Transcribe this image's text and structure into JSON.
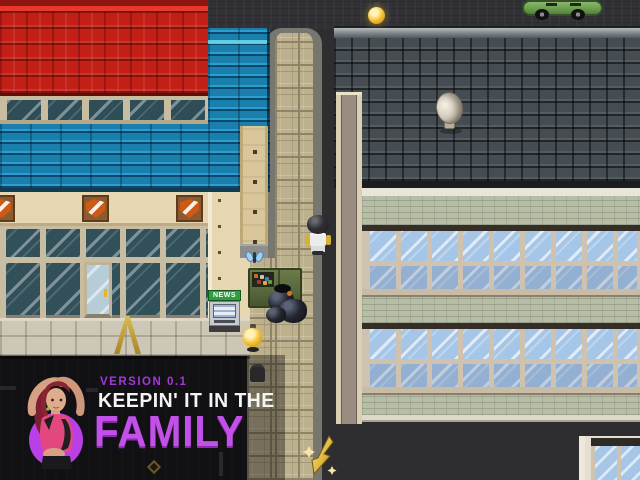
{
  "overlay": {
    "version_label": "VERSION 0.1",
    "title_line1": "KEEPIN' IT IN THE",
    "title_line2": "FAMILY",
    "colors": {
      "version_purple": "#a238da",
      "title_white": "#f4f4f4",
      "family_purple": "#c251ea",
      "circle_purple": "#b840e6"
    }
  },
  "scene": {
    "news_sign_label": "NEWS",
    "objects": [
      "red-shingle-roof",
      "blue-shingle-roof",
      "shield-emblems",
      "shop-windows",
      "glass-entrance-door",
      "sidewalk",
      "cobblestone-path",
      "slate-roof-building",
      "blue-window-rows",
      "satellite-dish",
      "green-car",
      "street-lamp-orbs",
      "npc-character",
      "green-dumpster",
      "garbage-bags",
      "blue-butterfly",
      "newspaper-vending-box",
      "yellow-a-frame-sign",
      "gold-quest-arrow",
      "road-markings"
    ],
    "palette": {
      "red_roof": "#c22016",
      "blue_roof": "#1b7fae",
      "slate_roof": "#454d52",
      "cobbles": "#bdb18d",
      "cream_wall": "#e6d7b2",
      "brick_band": "#b6bea6",
      "glass_blue": "#a6c6e8",
      "glass_dark": "#31505a",
      "asphalt": "#2e2e31",
      "dumpster_green": "#57673c",
      "lamp_yellow": "#f2bc2c"
    }
  }
}
